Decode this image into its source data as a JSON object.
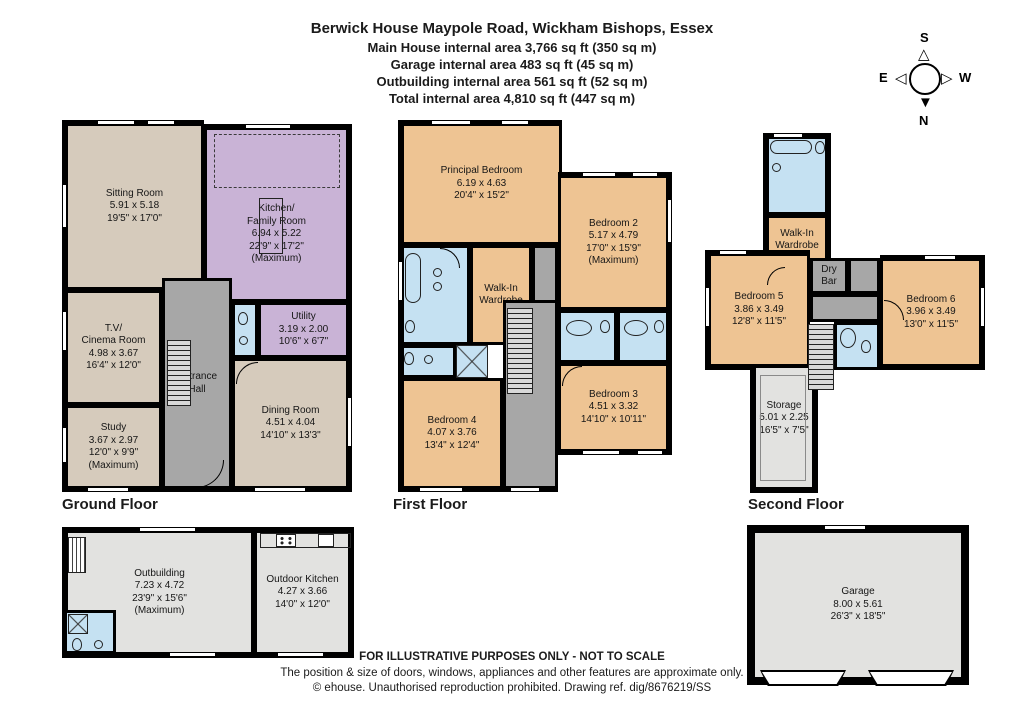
{
  "header": {
    "title": "Berwick House Maypole Road, Wickham Bishops, Essex",
    "line1": "Main House internal area 3,766 sq ft (350 sq m)",
    "line2": "Garage internal area 483 sq ft (45 sq m)",
    "line3": "Outbuilding internal area 561 sq ft (52 sq m)",
    "line4": "Total internal area 4,810 sq ft (447 sq m)"
  },
  "compass": {
    "north": "N",
    "south": "S",
    "east": "E",
    "west": "W"
  },
  "colors": {
    "sitting_beige": "#d6cbbc",
    "kitchen_purple": "#c9b3d6",
    "bedroom_orange": "#eec493",
    "bathroom_blue": "#c5e1f2",
    "hall_gray": "#a7a7a7",
    "storage_light_gray": "#e2e2e0",
    "wall_black": "#000000"
  },
  "floors": {
    "ground": {
      "label": "Ground Floor",
      "rooms": {
        "sitting": {
          "name": "Sitting Room",
          "dims_m": "5.91 x 5.18",
          "dims_ft": "19'5\" x 17'0\""
        },
        "kitchen": {
          "name": "Kitchen/",
          "name2": "Family Room",
          "dims_m": "6.94 x 5.22",
          "dims_ft": "22'9\" x 17'2\"",
          "note": "(Maximum)"
        },
        "tv": {
          "name": "T.V/",
          "name2": "Cinema Room",
          "dims_m": "4.98 x 3.67",
          "dims_ft": "16'4\" x 12'0\""
        },
        "utility": {
          "name": "Utility",
          "dims_m": "3.19 x 2.00",
          "dims_ft": "10'6\" x 6'7\""
        },
        "study": {
          "name": "Study",
          "dims_m": "3.67 x 2.97",
          "dims_ft": "12'0\" x 9'9\"",
          "note": "(Maximum)"
        },
        "hall": {
          "name": "Entrance Hall"
        },
        "dining": {
          "name": "Dining Room",
          "dims_m": "4.51 x 4.04",
          "dims_ft": "14'10\" x 13'3\""
        }
      }
    },
    "first": {
      "label": "First Floor",
      "rooms": {
        "principal": {
          "name": "Principal Bedroom",
          "dims_m": "6.19 x 4.63",
          "dims_ft": "20'4\" x 15'2\""
        },
        "bed2": {
          "name": "Bedroom 2",
          "dims_m": "5.17 x 4.79",
          "dims_ft": "17'0\" x 15'9\"",
          "note": "(Maximum)"
        },
        "wiw": {
          "name": "Walk-In Wardrobe"
        },
        "bed4": {
          "name": "Bedroom 4",
          "dims_m": "4.07 x 3.76",
          "dims_ft": "13'4\" x 12'4\""
        },
        "bed3": {
          "name": "Bedroom 3",
          "dims_m": "4.51 x 3.32",
          "dims_ft": "14'10\" x 10'11\""
        }
      }
    },
    "second": {
      "label": "Second Floor",
      "rooms": {
        "wiw": {
          "name": "Walk-In Wardrobe"
        },
        "bed5": {
          "name": "Bedroom 5",
          "dims_m": "3.86 x 3.49",
          "dims_ft": "12'8\" x 11'5\""
        },
        "drybar": {
          "name": "Dry Bar"
        },
        "bed6": {
          "name": "Bedroom 6",
          "dims_m": "3.96 x 3.49",
          "dims_ft": "13'0\" x 11'5\""
        },
        "storage": {
          "name": "Storage",
          "dims_m": "5.01 x 2.25",
          "dims_ft": "16'5\" x 7'5\""
        }
      }
    }
  },
  "outbuilding": {
    "rooms": {
      "outbuilding": {
        "name": "Outbuilding",
        "dims_m": "7.23 x 4.72",
        "dims_ft": "23'9\" x 15'6\"",
        "note": "(Maximum)"
      },
      "outdoor_kitchen": {
        "name": "Outdoor Kitchen",
        "dims_m": "4.27 x 3.66",
        "dims_ft": "14'0\" x 12'0\""
      }
    }
  },
  "garage": {
    "name": "Garage",
    "dims_m": "8.00 x 5.61",
    "dims_ft": "26'3\" x 18'5\""
  },
  "footer": {
    "line1": "FOR ILLUSTRATIVE PURPOSES ONLY - NOT TO SCALE",
    "line2": "The position & size of doors, windows, appliances and other features are approximate only.",
    "line3": "© ehouse. Unauthorised reproduction prohibited. Drawing ref. dig/8676219/SS"
  }
}
